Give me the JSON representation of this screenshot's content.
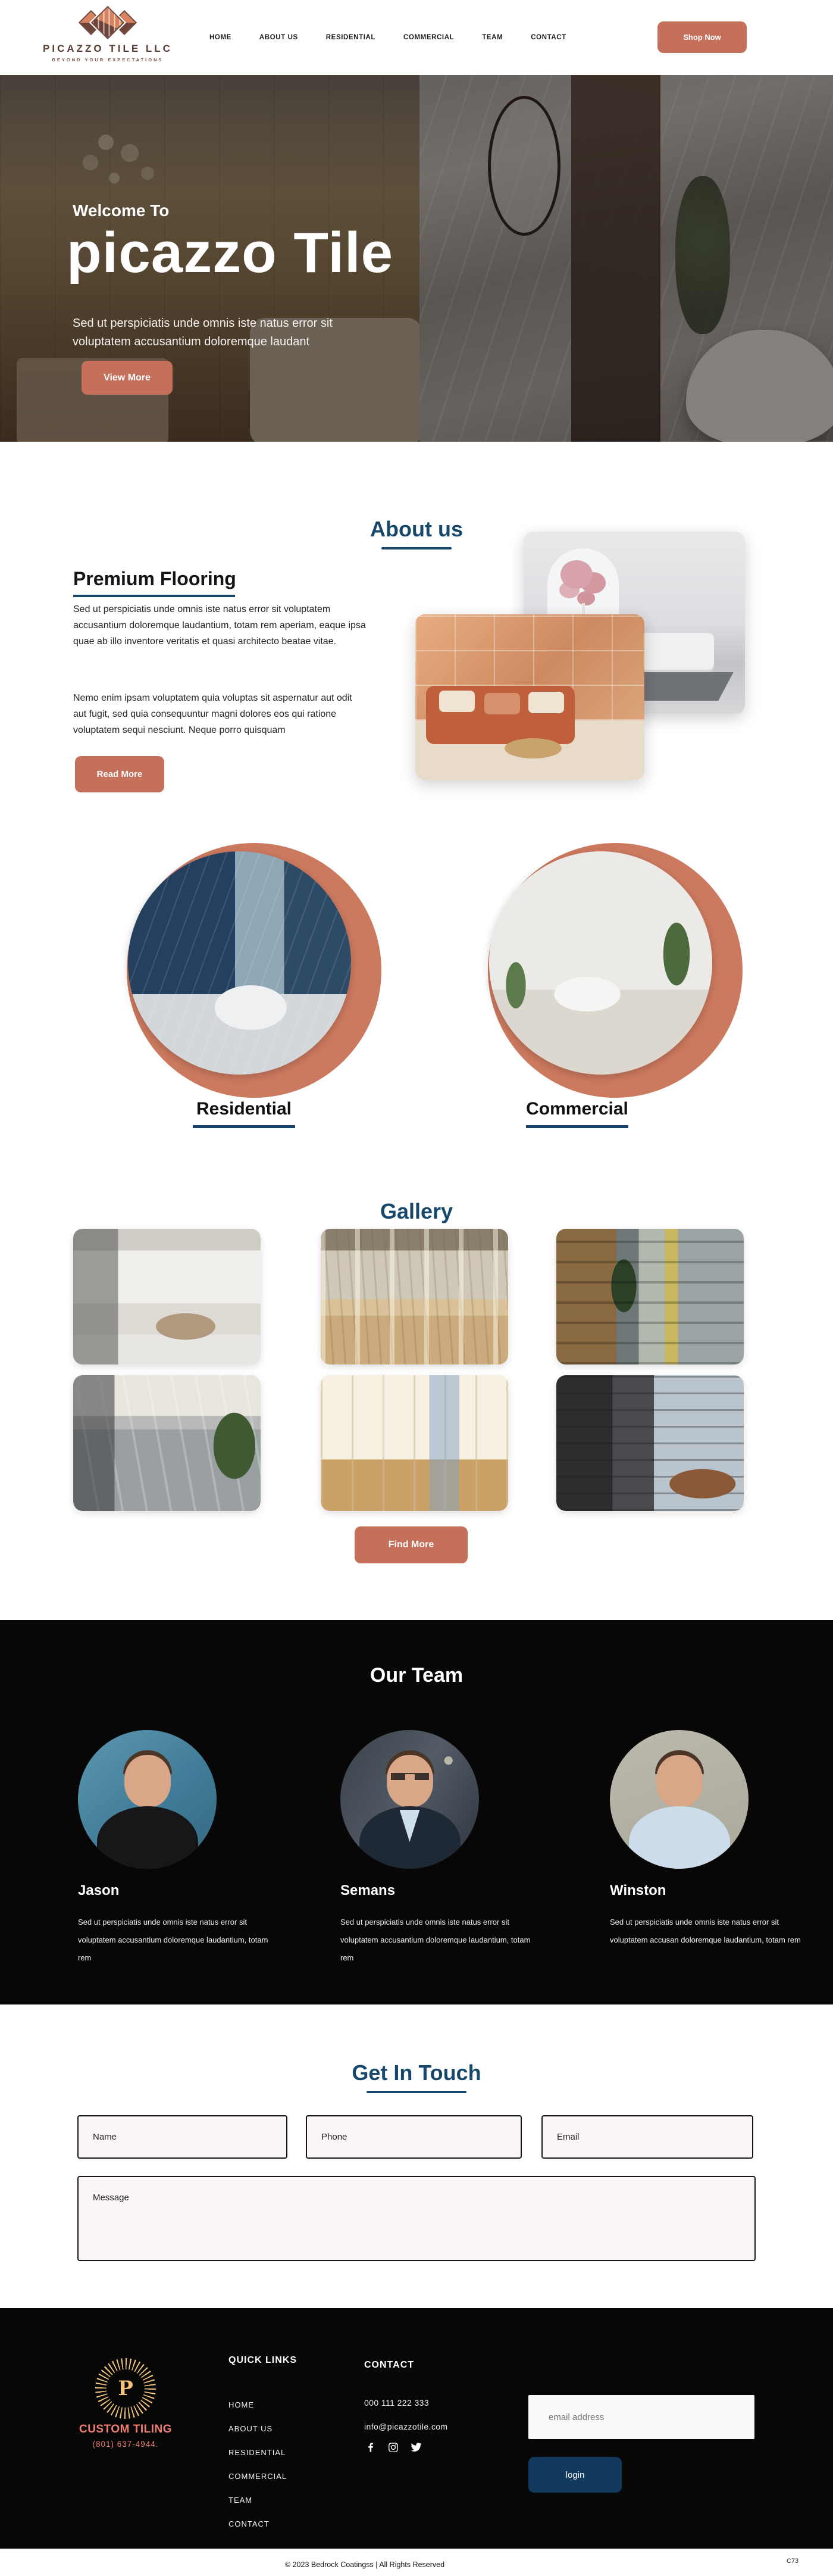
{
  "colors": {
    "terracotta": "#c4705a",
    "navy": "#17486b",
    "dark": "#070708",
    "ring": "#cc7a5f"
  },
  "header": {
    "brand": {
      "name": "PICAZZO TILE LLC",
      "tagline": "BEYOND YOUR EXPECTATIONS"
    },
    "nav": [
      "HOME",
      "ABOUT US",
      "RESIDENTIAL",
      "COMMERCIAL",
      "TEAM",
      "CONTACT"
    ],
    "shop_button": "Shop Now"
  },
  "hero": {
    "welcome": "Welcome To",
    "title": "picazzo Tile",
    "subtitle_line1": "Sed ut perspiciatis unde omnis iste natus error sit",
    "subtitle_line2": "voluptatem accusantium doloremque laudant",
    "view_more": "View More"
  },
  "about": {
    "section_title": "About us",
    "heading": "Premium Flooring",
    "paragraph1": "Sed ut perspiciatis unde omnis iste natus error sit voluptatem accusantium doloremque laudantium, totam rem aperiam, eaque ipsa quae ab illo inventore veritatis et quasi architecto beatae vitae.",
    "paragraph2": "Nemo enim ipsam voluptatem quia voluptas sit aspernatur aut odit aut fugit, sed quia consequuntur magni dolores eos qui ratione voluptatem sequi nesciunt. Neque porro quisquam",
    "read_more": "Read More"
  },
  "categories": {
    "residential": "Residential",
    "commercial": "Commercial"
  },
  "gallery": {
    "title": "Gallery",
    "find_more": "Find More",
    "images": [
      "dining-room-marble-floor",
      "mirror-hall-wood-floor",
      "office-corridor-wood-wall",
      "outdoor-walkway-gray-tile",
      "cream-kitchen",
      "office-lounge-city-view"
    ]
  },
  "team": {
    "title": "Our Team",
    "members": [
      {
        "name": "Jason",
        "bio": "Sed ut perspiciatis unde omnis iste natus error sit voluptatem accusantium doloremque laudantium, totam rem"
      },
      {
        "name": "Semans",
        "bio": "Sed ut perspiciatis unde omnis iste natus error sit voluptatem accusantium doloremque laudantium, totam rem"
      },
      {
        "name": "Winston",
        "bio": "Sed ut perspiciatis unde omnis iste natus error sit voluptatem accusan doloremque laudantium, totam rem"
      }
    ]
  },
  "contact_form": {
    "title": "Get In Touch",
    "name_placeholder": "Name",
    "phone_placeholder": "Phone",
    "email_placeholder": "Email",
    "message_placeholder": "Message"
  },
  "footer": {
    "logo": {
      "letter": "P",
      "name": "CUSTOM TILING",
      "phone": "(801) 637-4944."
    },
    "quick_links": {
      "title": "QUICK LINKS",
      "items": [
        "HOME",
        "ABOUT US",
        "RESIDENTIAL",
        "COMMERCIAL",
        "TEAM",
        "CONTACT"
      ]
    },
    "contact": {
      "title": "CONTACT",
      "phone": "000 111 222 333",
      "email": "info@picazzotile.com",
      "socials": [
        "facebook",
        "instagram",
        "twitter"
      ]
    },
    "newsletter": {
      "placeholder": "email address",
      "button": "login"
    }
  },
  "bottom": {
    "copyright": "© 2023 Bedrock Coatingss | All Rights Reserved",
    "code": "C73"
  }
}
